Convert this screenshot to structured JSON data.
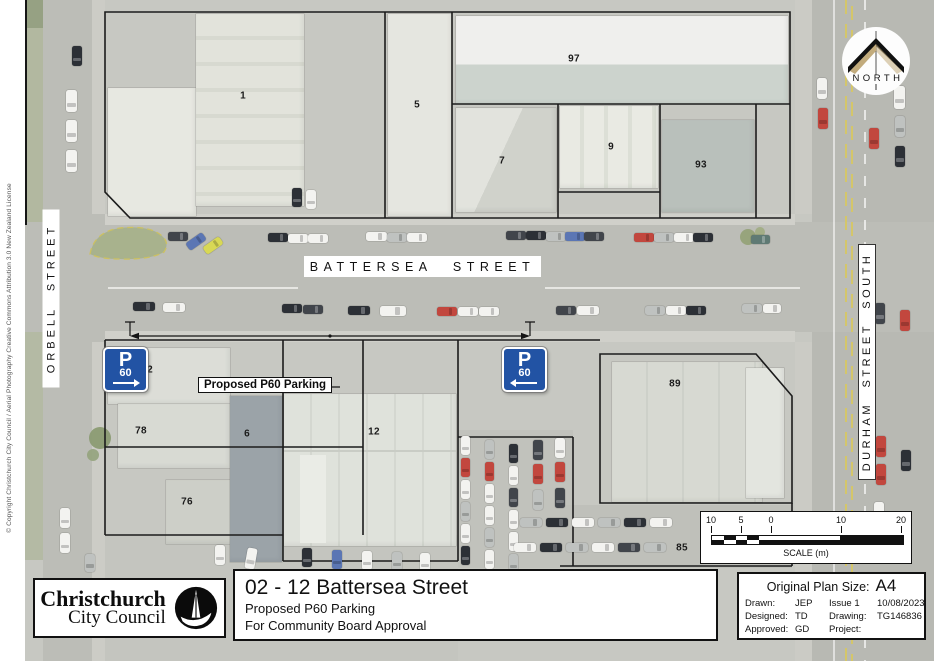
{
  "map": {
    "streets": {
      "battersea": "BATTERSEA STREET",
      "orbell": "ORBELL STREET",
      "durham": "DURHAM STREET SOUTH"
    },
    "north_label": "NORTH",
    "annotation_label": "Proposed P60 Parking",
    "p60_sign": {
      "p": "P",
      "minutes": "60"
    },
    "parcel_labels": [
      "1",
      "5",
      "97",
      "7",
      "9",
      "93",
      "2",
      "78",
      "6",
      "12",
      "76",
      "89",
      "85"
    ],
    "scale_bar": {
      "ticks": [
        "10",
        "5",
        "0",
        "10",
        "20"
      ],
      "label": "SCALE (m)"
    },
    "copyright": "© Copyright Christchurch City Council / Aerial Photography Creative Commons Attribution 3.0 New Zealand License",
    "colors": {
      "sign_blue": "#2253a4",
      "parcel_outline": "#1c1c1c"
    }
  },
  "title_block": {
    "logo_line1": "Christchurch",
    "logo_line2": "City Council",
    "title": "02 - 12 Battersea Street",
    "subtitle": "Proposed P60 Parking",
    "approval_line": "For Community Board Approval",
    "info": {
      "plan_size_label": "Original Plan Size:",
      "plan_size_value": "A4",
      "rows": [
        {
          "c1": "Drawn:",
          "c2": "JEP",
          "c3": "Issue 1",
          "c4": "10/08/2023"
        },
        {
          "c1": "Designed:",
          "c2": "TD",
          "c3": "Drawing:",
          "c4": "TG146836"
        },
        {
          "c1": "Approved:",
          "c2": "GD",
          "c3": "Project:",
          "c4": ""
        }
      ]
    }
  }
}
